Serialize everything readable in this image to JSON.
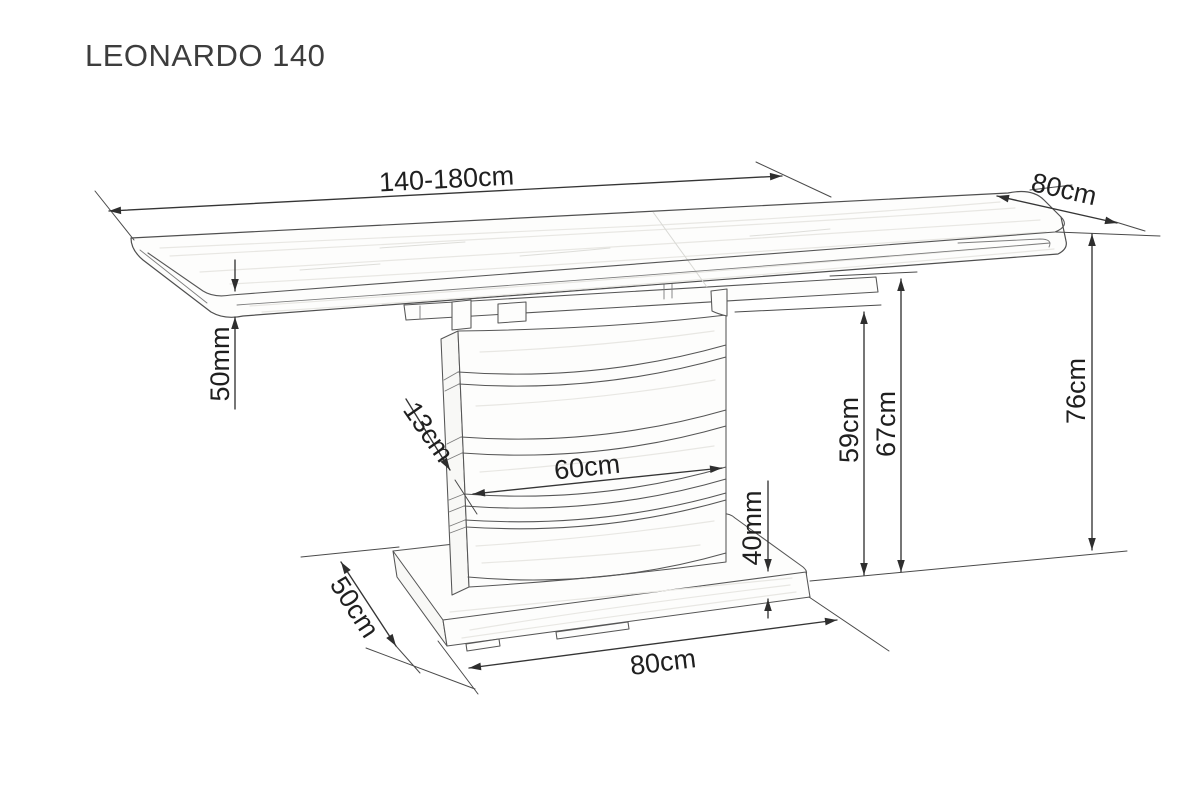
{
  "title": "LEONARDO 140",
  "drawing": {
    "product": "LEONARDO 140",
    "dimensions": {
      "top_length": "140-180cm",
      "top_depth": "80cm",
      "top_thickness": "50mm",
      "total_height": "76cm",
      "column_depth": "13cm",
      "column_width": "60cm",
      "apron_height": "59cm",
      "underside_height": "67cm",
      "base_thickness": "40mm",
      "base_depth": "50cm",
      "base_width": "80cm"
    }
  }
}
